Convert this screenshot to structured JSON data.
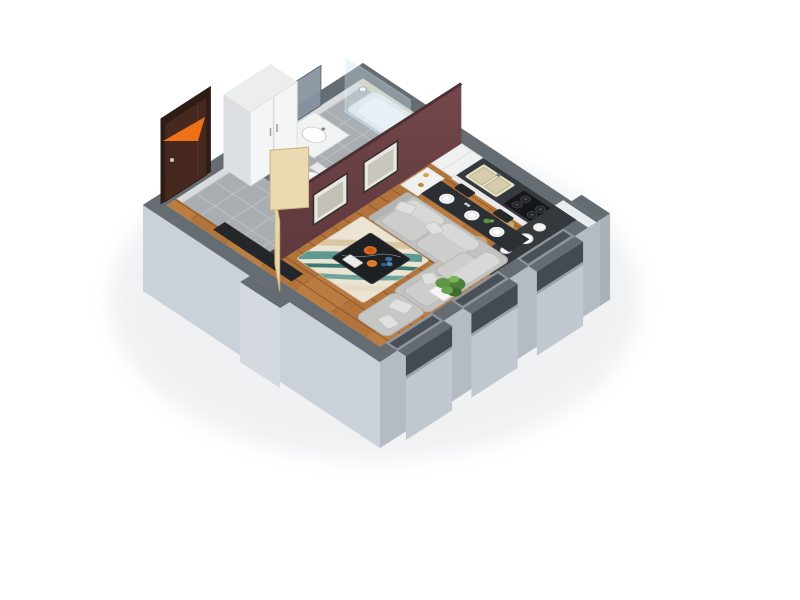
{
  "meta": {
    "title": "3D isometric render of a studio apartment floor plan",
    "view": "isometric cutaway, no visible text"
  },
  "colors": {
    "background": "#ffffff",
    "arrow": "#ed7117",
    "wall_top": "#656c72",
    "wall_face_light": "#cbd1d8",
    "wall_face_mid": "#b4bbc3",
    "wall_face_bay": "#c0c7ce",
    "window_glass": "#434a51",
    "interior_face": "#d8dbde",
    "accent_wall": "#6b4145",
    "wood_floor": "#b2743a",
    "tile_floor": "#a9aeb3",
    "kitchen_counter": "#34393d",
    "backsplash": "#1c1d1f",
    "cabinet_white": "#eff0f0",
    "sofa": "#c2c2c0",
    "rug_base": "#ebe4d3",
    "rug_teal": "#5f9a92",
    "coffee_table": "#1e2124",
    "dining_table": "#2c3034",
    "entrance_door": "#46281e",
    "interior_door": "#e7d6ab",
    "stool": "#c9a671",
    "plant": "#4c7f38",
    "bathtub": "#e9ecec",
    "lowboard": "#24272a"
  },
  "scene": {
    "rooms": [
      {
        "name": "hallway",
        "floor": "gray tile"
      },
      {
        "name": "bathroom",
        "floor": "gray tile",
        "fixtures": [
          "bathtub",
          "shower-glass",
          "shower-head",
          "vanity-sink",
          "mirror",
          "toilet"
        ]
      },
      {
        "name": "kitchen",
        "fixtures": [
          "tall-cabinet",
          "counter",
          "double-sink",
          "gas-hob",
          "bar-counter",
          "bar-stools",
          "kettle"
        ]
      },
      {
        "name": "living-dining",
        "fixtures": [
          "corner-sofa",
          "pillows",
          "coffee-table",
          "rug",
          "dining-table",
          "place-settings",
          "shelf",
          "lowboard",
          "potted-plant"
        ]
      }
    ],
    "openings": [
      "entrance-door",
      "bathroom-door",
      "hall-door",
      "window-1",
      "window-2",
      "window-3",
      "corner-niche"
    ],
    "decor": [
      "wall-picture-1",
      "wall-picture-2"
    ],
    "annotations": [
      {
        "name": "entrance-arrow",
        "meaning": "points to apartment entrance",
        "color": "#ed7117"
      }
    ]
  }
}
